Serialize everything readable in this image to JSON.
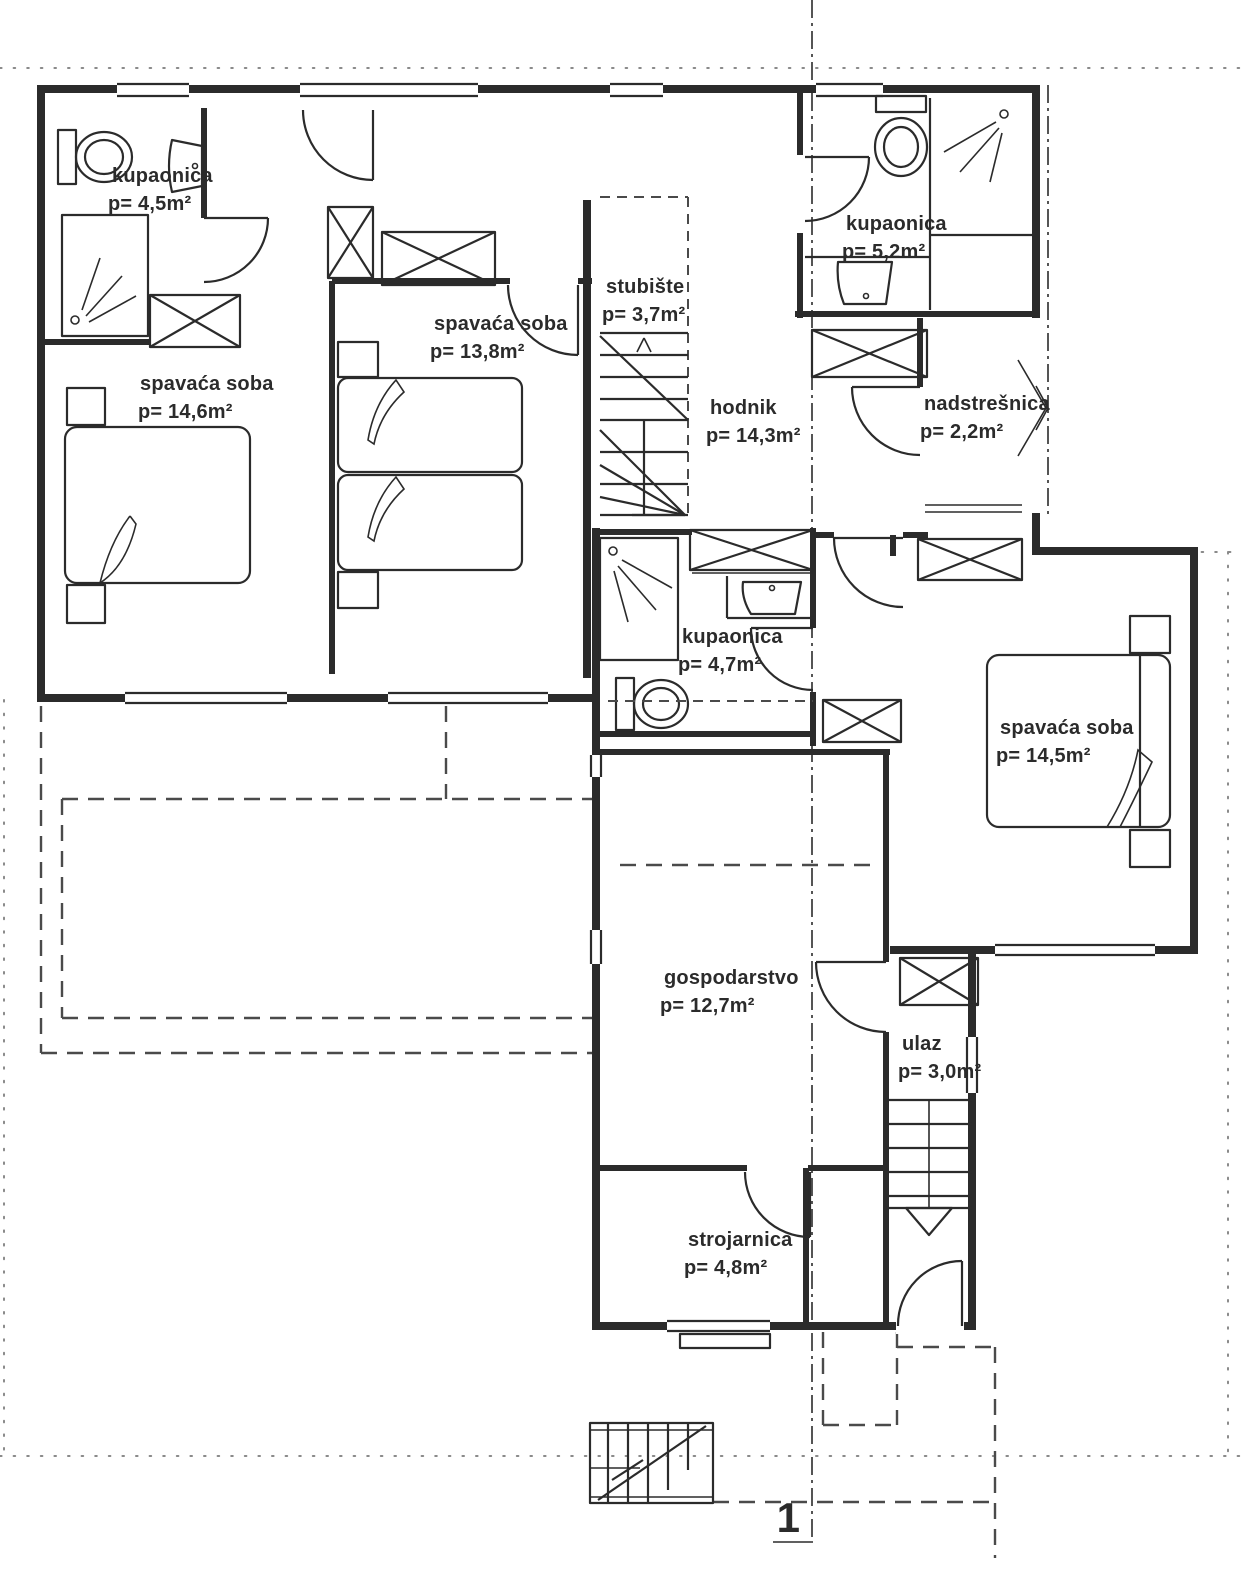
{
  "drawing": {
    "kind": "architectural floor plan",
    "section_marker": "1"
  },
  "colors": {
    "ink": "#2b2b2b",
    "dash": "#4a4a4a",
    "dots": "#8a8a8a",
    "background": "#ffffff"
  },
  "rooms": [
    {
      "id": "kupaonica-1",
      "name": "kupaonica",
      "area": "p= 4,5m²"
    },
    {
      "id": "spavaca-1",
      "name": "spavaća soba",
      "area": "p= 14,6m²"
    },
    {
      "id": "spavaca-2",
      "name": "spavaća soba",
      "area": "p= 13,8m²"
    },
    {
      "id": "stubiste",
      "name": "stubište",
      "area": "p= 3,7m²"
    },
    {
      "id": "hodnik",
      "name": "hodnik",
      "area": "p= 14,3m²"
    },
    {
      "id": "kupaonica-2",
      "name": "kupaonica",
      "area": "p= 5,2m²"
    },
    {
      "id": "nadstresnica",
      "name": "nadstrešnica",
      "area": "p= 2,2m²"
    },
    {
      "id": "kupaonica-3",
      "name": "kupaonica",
      "area": "p= 4,7m²"
    },
    {
      "id": "spavaca-3",
      "name": "spavaća soba",
      "area": "p= 14,5m²"
    },
    {
      "id": "gospodarstvo",
      "name": "gospodarstvo",
      "area": "p= 12,7m²"
    },
    {
      "id": "ulaz",
      "name": "ulaz",
      "area": "p= 3,0m²"
    },
    {
      "id": "strojarnica",
      "name": "strojarnica",
      "area": "p= 4,8m²"
    }
  ]
}
